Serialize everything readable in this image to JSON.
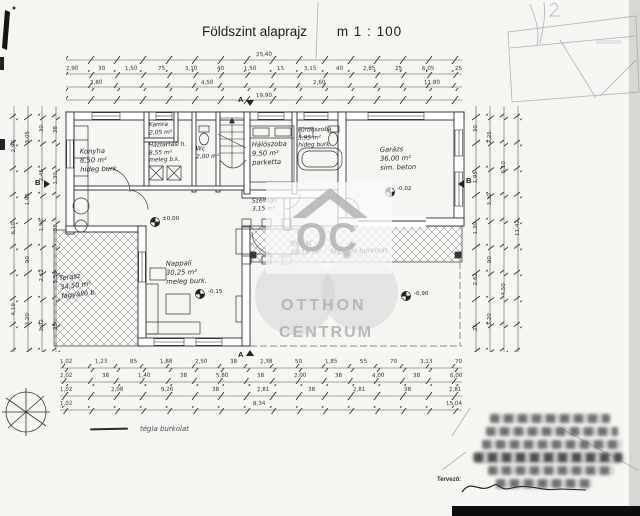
{
  "page": {
    "title": "Földszint alaprajz",
    "scale": "m 1 : 100"
  },
  "watermark": {
    "monogram": "OC",
    "line1": "OTTHON",
    "line2": "CENTRUM",
    "color": "#b2b2b2"
  },
  "rooms": [
    {
      "name": "Konyha",
      "area": "8,50 m²",
      "note": "hideg burk."
    },
    {
      "name": "Kamra",
      "area": "2,05 m²",
      "note": "h.b."
    },
    {
      "name": "Háztartási h.",
      "area": "8,55 m²",
      "note": "meleg b.k."
    },
    {
      "name": "Wc",
      "area": "2,00 m²",
      "note": "h.b."
    },
    {
      "name": "Hálószoba",
      "area": "9,50 m²",
      "note": "parketta"
    },
    {
      "name": "Fürdőszoba",
      "area": "5,95 m²",
      "note": "hideg burk."
    },
    {
      "name": "Garázs",
      "area": "36,00 m²",
      "note": "sim. beton"
    },
    {
      "name": "Nappali",
      "area": "30,25 m²",
      "note": "meleg burk."
    },
    {
      "name": "Szélfogó",
      "area": "3,15 m²",
      "note": "h. burk."
    },
    {
      "name": "Tornác",
      "area": "28,18 m²",
      "note": "fagyálló burkolat"
    },
    {
      "name": "Terasz",
      "area": "34,50 m²",
      "note": "fagyálló b."
    }
  ],
  "levels": [
    "±0,00",
    "-0,15",
    "-0,02",
    "-0,90"
  ],
  "sections": {
    "top": "A",
    "bottom": "A",
    "left": "B",
    "right": "B"
  },
  "legend": {
    "note": "tégla burkolat"
  },
  "stamp": {
    "designer": "Tervező:"
  },
  "dims": {
    "top1": [
      "25,40"
    ],
    "top2": [
      "2,90",
      "30",
      "1,50",
      "75",
      "3,10",
      "40",
      "1,50",
      "15",
      "3,15",
      "40",
      "2,85",
      "25",
      "6,05",
      "25"
    ],
    "top3": [
      "3,80",
      "4,50",
      "2,60",
      "11,80"
    ],
    "top4": [
      "19,90"
    ],
    "bottom1": [
      "1,02",
      "1,23",
      "85",
      "1,88",
      "2,50",
      "38",
      "2,38",
      "50",
      "1,85",
      "55",
      "70",
      "3,13",
      "70"
    ],
    "bottom2": [
      "2,02",
      "38",
      "1,40",
      "38",
      "5,80",
      "38",
      "2,00",
      "38",
      "4,00",
      "38",
      "6,00"
    ],
    "bottom3": [
      "1,02",
      "2,08",
      "9,26",
      "38",
      "2,81",
      "38",
      "2,81",
      "38",
      "2,81"
    ],
    "bottom4": [
      "1,02",
      "8,34",
      "15,04"
    ],
    "left_outer": [
      "2,90",
      "6,10",
      "4,19"
    ],
    "left_mid1": [
      "3,05",
      "1,95",
      "90",
      "2,20"
    ],
    "left_mid2": [
      "30",
      "2,45",
      "1,50",
      "2,62",
      "3,02"
    ],
    "left_inner": [
      "38",
      "1,30",
      "38",
      "5,56",
      "25"
    ],
    "right_inner": [
      "30",
      "1,95",
      "1,30",
      "2,62",
      "25"
    ],
    "right_mid2": [
      "2,25",
      "3,30",
      "90",
      "1,20"
    ],
    "right_mid1": [
      "6,10",
      "4,50"
    ],
    "right_outer": [
      "11,42"
    ]
  }
}
